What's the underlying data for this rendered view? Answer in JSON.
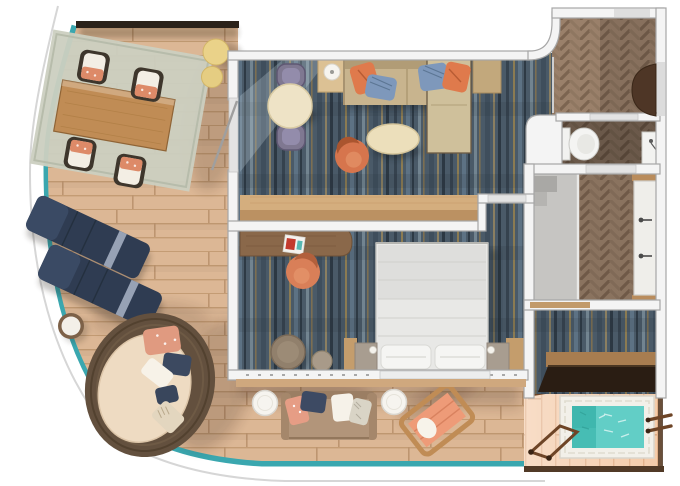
{
  "scene": {
    "type": "floor-plan",
    "subject": "cruise-ship-suite-top-view-floor-plan",
    "rooms": [
      "wrap-around-balcony-terrace",
      "living-room",
      "bedroom",
      "entry-hall",
      "toilet-room",
      "bathroom",
      "dressing-area",
      "aft-deck",
      "hot-tub-deck"
    ],
    "furniture": [
      "outdoor-dining-table",
      "outdoor-dining-chairs",
      "round-poufs",
      "sun-loungers",
      "round-side-table",
      "wicker-daybed",
      "indoor-dining-table",
      "dining-chairs",
      "lamp-side-table",
      "sofa-with-chaise",
      "oval-coffee-table",
      "swivel-chair",
      "bar-counter",
      "writing-desk",
      "desk-chair",
      "double-bed",
      "nightstands",
      "ottoman-pouf",
      "stool",
      "toilet",
      "wc-sink",
      "shower",
      "double-vanity",
      "dark-console",
      "outdoor-loveseat",
      "outdoor-side-tables",
      "wooden-lounge-chair",
      "whirlpool-hot-tub",
      "deck-grab-rails"
    ]
  },
  "palette": {
    "background": "#ffffff",
    "hullLine": "#d6d6d6",
    "edgeTeal": "#3aa7af",
    "deckBase": "#dcb795",
    "deckLine": "#c49c74",
    "deckLightBase": "#f4cba9",
    "deckLightLine": "#e2af87",
    "carpetBase": "#4a5a68",
    "carpetGold": "#97814f",
    "carpetDark": "#303d49",
    "carpetLight": "#93a5b1",
    "herrBase": "#9a806a",
    "herrDark": "#7c6450",
    "herrMid": "#8f7761",
    "wallFill": "#f4f4f4",
    "wallStroke": "#a6a6a6",
    "threshold": "#e3e3e3",
    "waterTeal": "#62cec6",
    "waterDark": "#3fb7ae",
    "tileWhite": "#f2f0e9",
    "sofaBeige": "#c8b48e",
    "sofaBack": "#b19c76",
    "chaiseBeige": "#cfc09b",
    "pillowOrange": "#df7a4c",
    "pillowBlue": "#7e98bb",
    "woodCounterTop": "#d4ae7e",
    "woodCounterFront": "#bb9162",
    "woodDesk": "#8a684a",
    "tableCream": "#eee3c6",
    "coffeeCream": "#ecdfbb",
    "chairPurple": "#7f7891",
    "chairCoral": "#d6754d",
    "loungerNavy": "#2f3c52",
    "wickerBrown": "#63503e",
    "cushionCream": "#eedbc2",
    "bedWhite": "#e8e8e6",
    "pillowWhite": "#f5f5f3",
    "nightstandTaupe": "#a89d90",
    "ledgeTan": "#c49d6c",
    "doorBrown": "#4e3626",
    "darkConsole": "#2a1d13",
    "deckEdgeBrown": "#513a27",
    "railBrown": "#6e4527",
    "rugSage": "#cbcfc0",
    "poufYellow": "#ead289",
    "loveseatTan": "#b2957a",
    "loungeWood": "#c08c55",
    "loungeCoral": "#ee9b78",
    "showerGray": "#c6c5c2",
    "sillTan": "#cfa87e"
  }
}
